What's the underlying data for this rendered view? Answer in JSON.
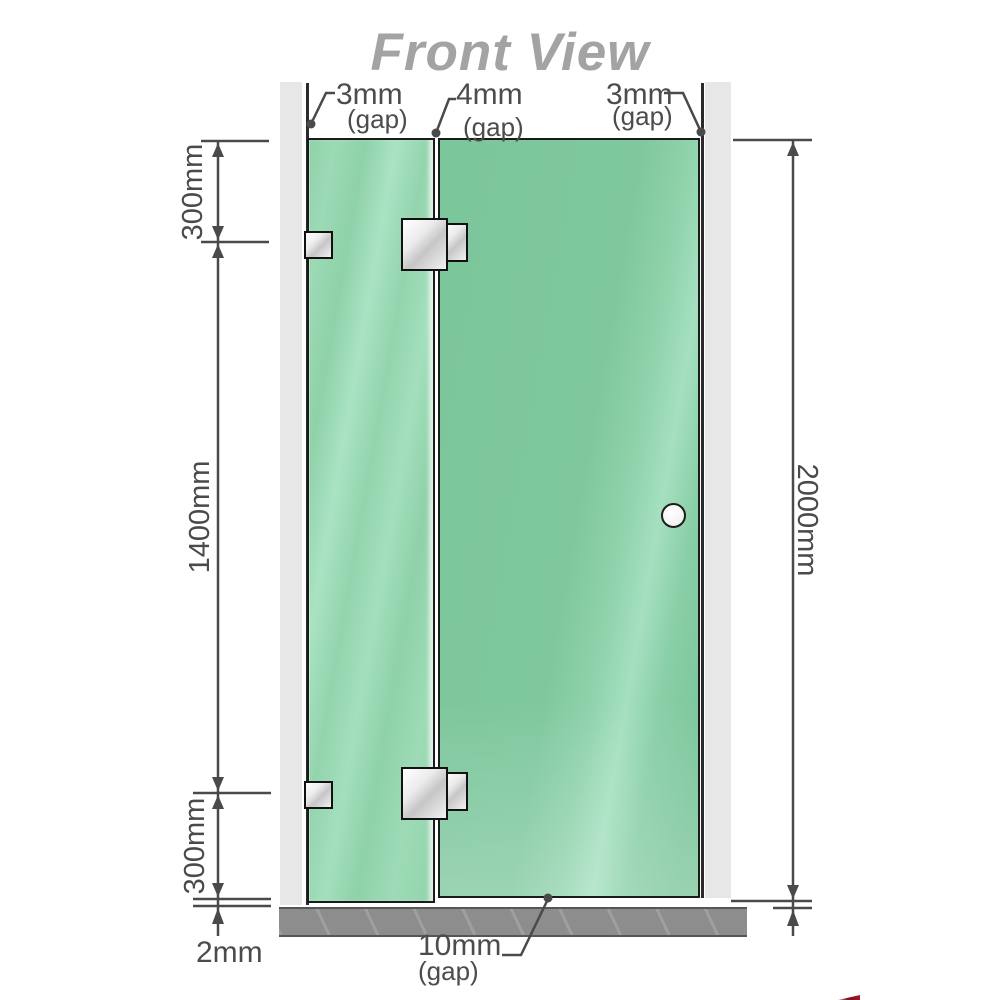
{
  "title": "Front View",
  "gap_labels": {
    "left": {
      "value": "3mm",
      "note": "(gap)"
    },
    "middle": {
      "value": "4mm",
      "note": "(gap)"
    },
    "right": {
      "value": "3mm",
      "note": "(gap)"
    },
    "bottom": {
      "value": "10mm",
      "note": "(gap)"
    },
    "floor": {
      "value": "2mm"
    }
  },
  "dimension_labels": {
    "left_top": "300mm",
    "left_middle": "1400mm",
    "left_bottom": "300mm",
    "right_overall": "2000mm"
  },
  "colors": {
    "glass_green_base": "#84cba2",
    "glass_green_light": "#a6e0c0",
    "wall_gray": "#e7e7e7",
    "floor_gray": "#8d8d8d",
    "outline_dark": "#1b1b1b",
    "dimension_gray": "#4a4a4a",
    "title_gray": "#a3a3a3",
    "hinge_silver": "#d9d9d9",
    "logo_red": "#7d0f1d"
  }
}
